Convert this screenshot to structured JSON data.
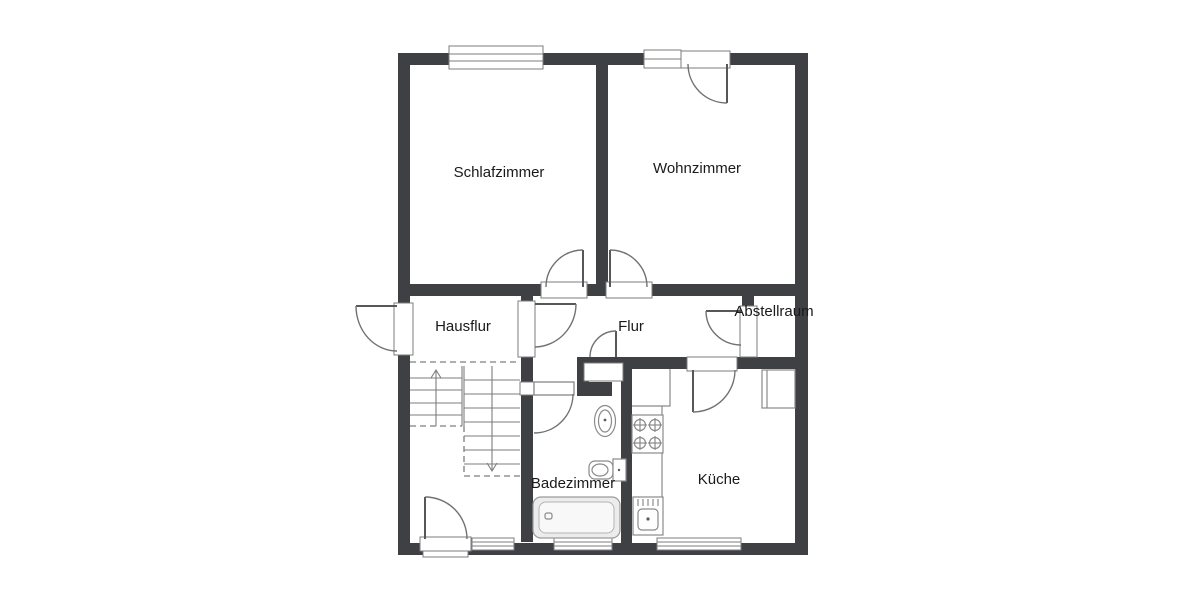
{
  "rooms": {
    "schlafzimmer": "Schlafzimmer",
    "wohnzimmer": "Wohnzimmer",
    "hausflur": "Hausflur",
    "flur": "Flur",
    "abstellraum": "Abstellraum",
    "badezimmer": "Badezimmer",
    "kueche": "Küche"
  },
  "colors": {
    "wall": "#3e4043",
    "line": "#7d7d7d",
    "fixture_line": "#8a8a8a",
    "text": "#1a1a1a",
    "tub_fill": "#ececec"
  }
}
